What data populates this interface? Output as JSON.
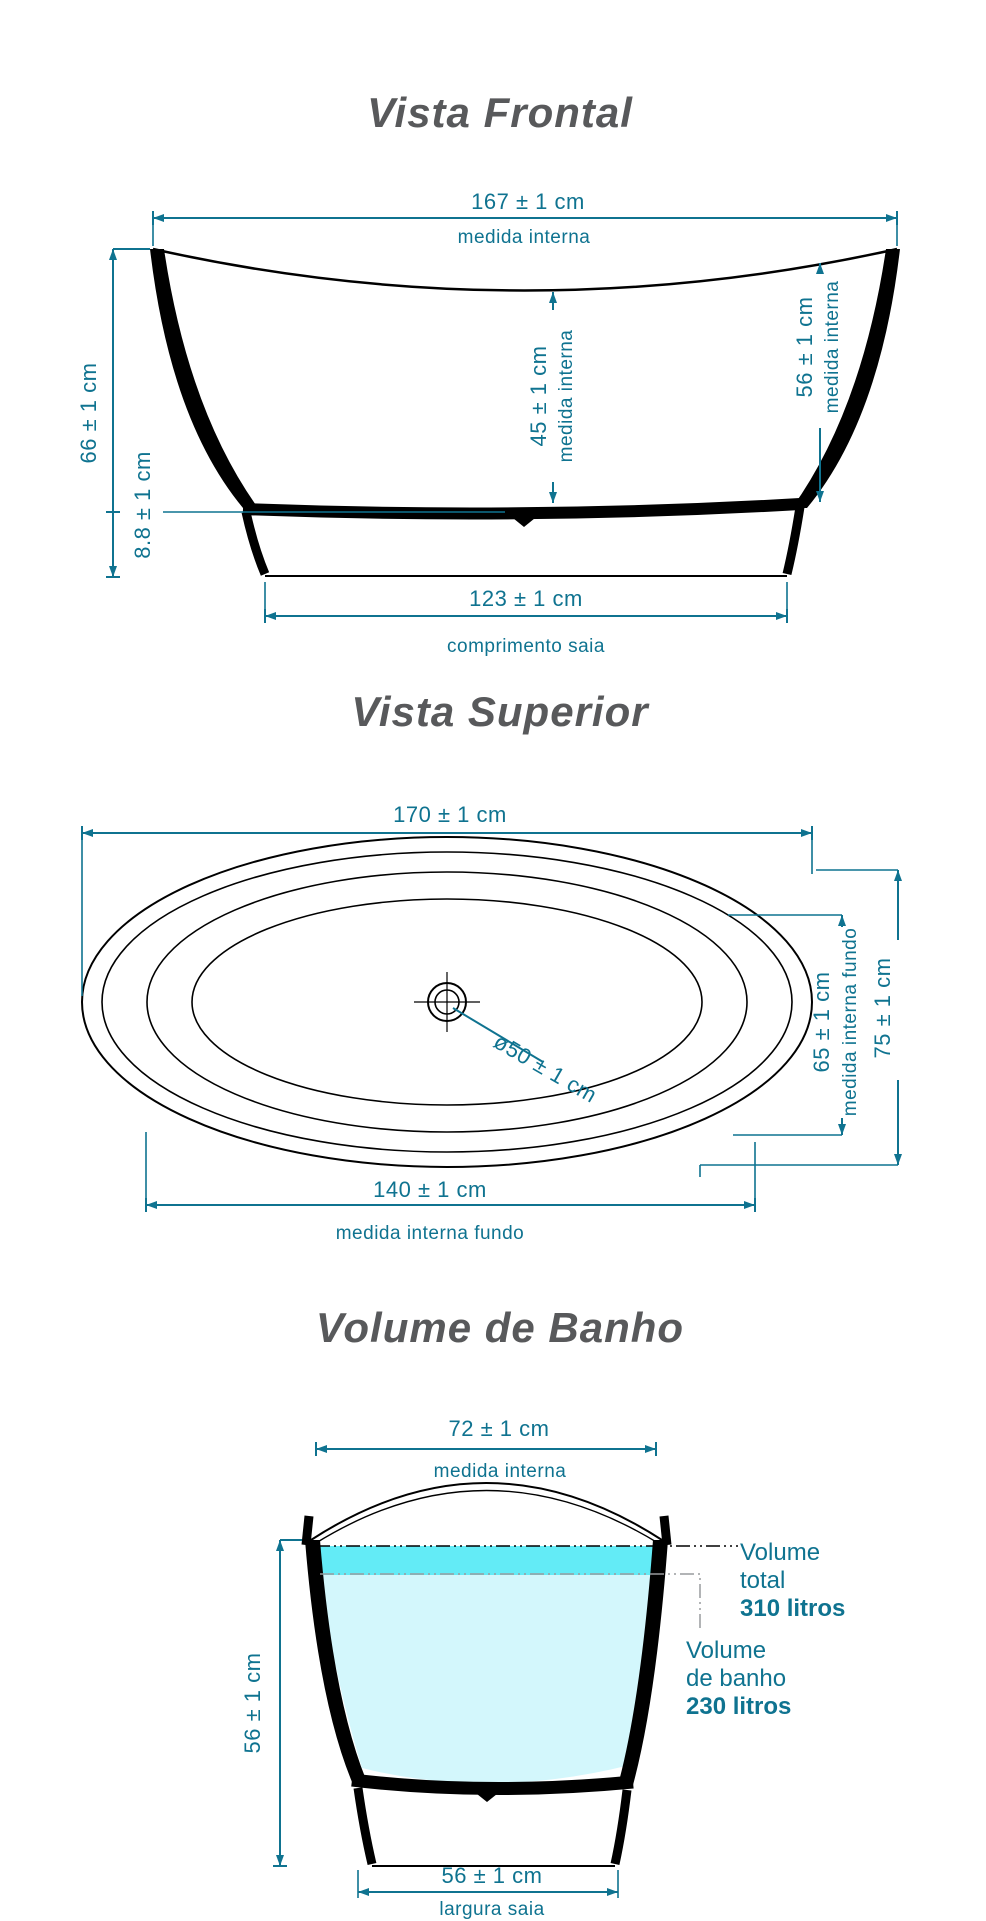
{
  "document": {
    "type": "bathtub technical drawing",
    "accent_color": "#0f7390",
    "title_color": "#58595b",
    "water_total_band_color": "#63ebf6",
    "water_bath_color": "#d3f7fc"
  },
  "front_view": {
    "title": "Vista Frontal",
    "dim_top_width": {
      "value": "167 ± 1 cm",
      "label": "medida interna"
    },
    "dim_total_height": {
      "value": "66 ± 1 cm"
    },
    "dim_skirt_height": {
      "value": "8.8 ± 1 cm"
    },
    "dim_inner_depth_center": {
      "value": "45 ± 1 cm",
      "label": "medida interna"
    },
    "dim_inner_depth_right": {
      "value": "56 ± 1 cm",
      "label": "medida interna"
    },
    "dim_skirt_length": {
      "value": "123 ± 1 cm",
      "label": "comprimento saia"
    }
  },
  "top_view": {
    "title": "Vista Superior",
    "dim_outer_length": {
      "value": "170 ± 1 cm"
    },
    "dim_floor_width": {
      "value": "65 ± 1 cm",
      "label": "medida interna fundo"
    },
    "dim_outer_width": {
      "value": "75 ± 1 cm"
    },
    "dim_floor_length": {
      "value": "140 ± 1 cm",
      "label": "medida interna fundo"
    },
    "dim_drain_diameter": {
      "value": "ø50 ± 1 cm"
    }
  },
  "volume_view": {
    "title": "Volume de Banho",
    "dim_inner_width": {
      "value": "72 ± 1 cm",
      "label": "medida interna"
    },
    "dim_height": {
      "value": "56 ± 1 cm"
    },
    "dim_skirt_width": {
      "value": "56 ± 1 cm",
      "label": "largura saia"
    },
    "volume_total": {
      "line1": "Volume",
      "line2": "total",
      "value": "310 litros"
    },
    "volume_bath": {
      "line1": "Volume",
      "line2": "de banho",
      "value": "230 litros"
    }
  }
}
